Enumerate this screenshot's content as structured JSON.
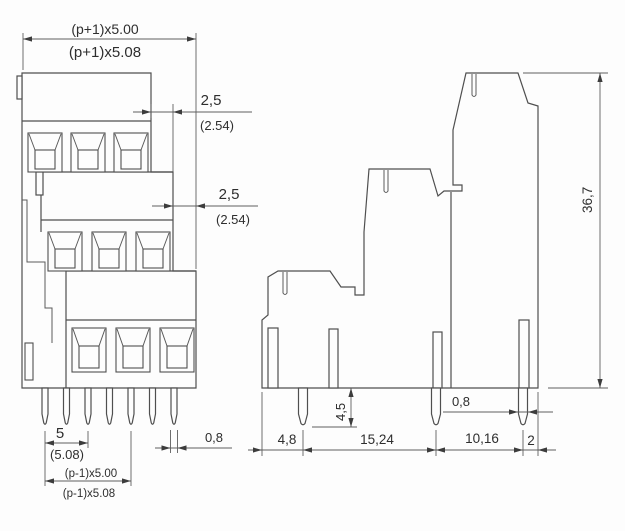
{
  "front_view": {
    "overall_width_mm": "(p+1)x5.00",
    "overall_width_alt": "(p+1)x5.08",
    "tier_offset_top_mm": "2,5",
    "tier_offset_top_alt": "(2.54)",
    "tier_offset_mid_mm": "2,5",
    "tier_offset_mid_alt": "(2.54)",
    "pin_pitch_mm": "5",
    "pin_pitch_alt": "(5.08)",
    "pin_row_span_mm": "(p-1)x5.00",
    "pin_row_span_alt": "(p-1)x5.08",
    "pin_width_mm": "0,8"
  },
  "side_view": {
    "overall_height_mm": "36,7",
    "pin_protrusion_mm": "4,5",
    "pin_width_mm": "0,8",
    "pitch_left_mm": "4,8",
    "pitch_mid_mm": "15,24",
    "pitch_right_mm": "10,16",
    "edge_offset_mm": "2"
  }
}
